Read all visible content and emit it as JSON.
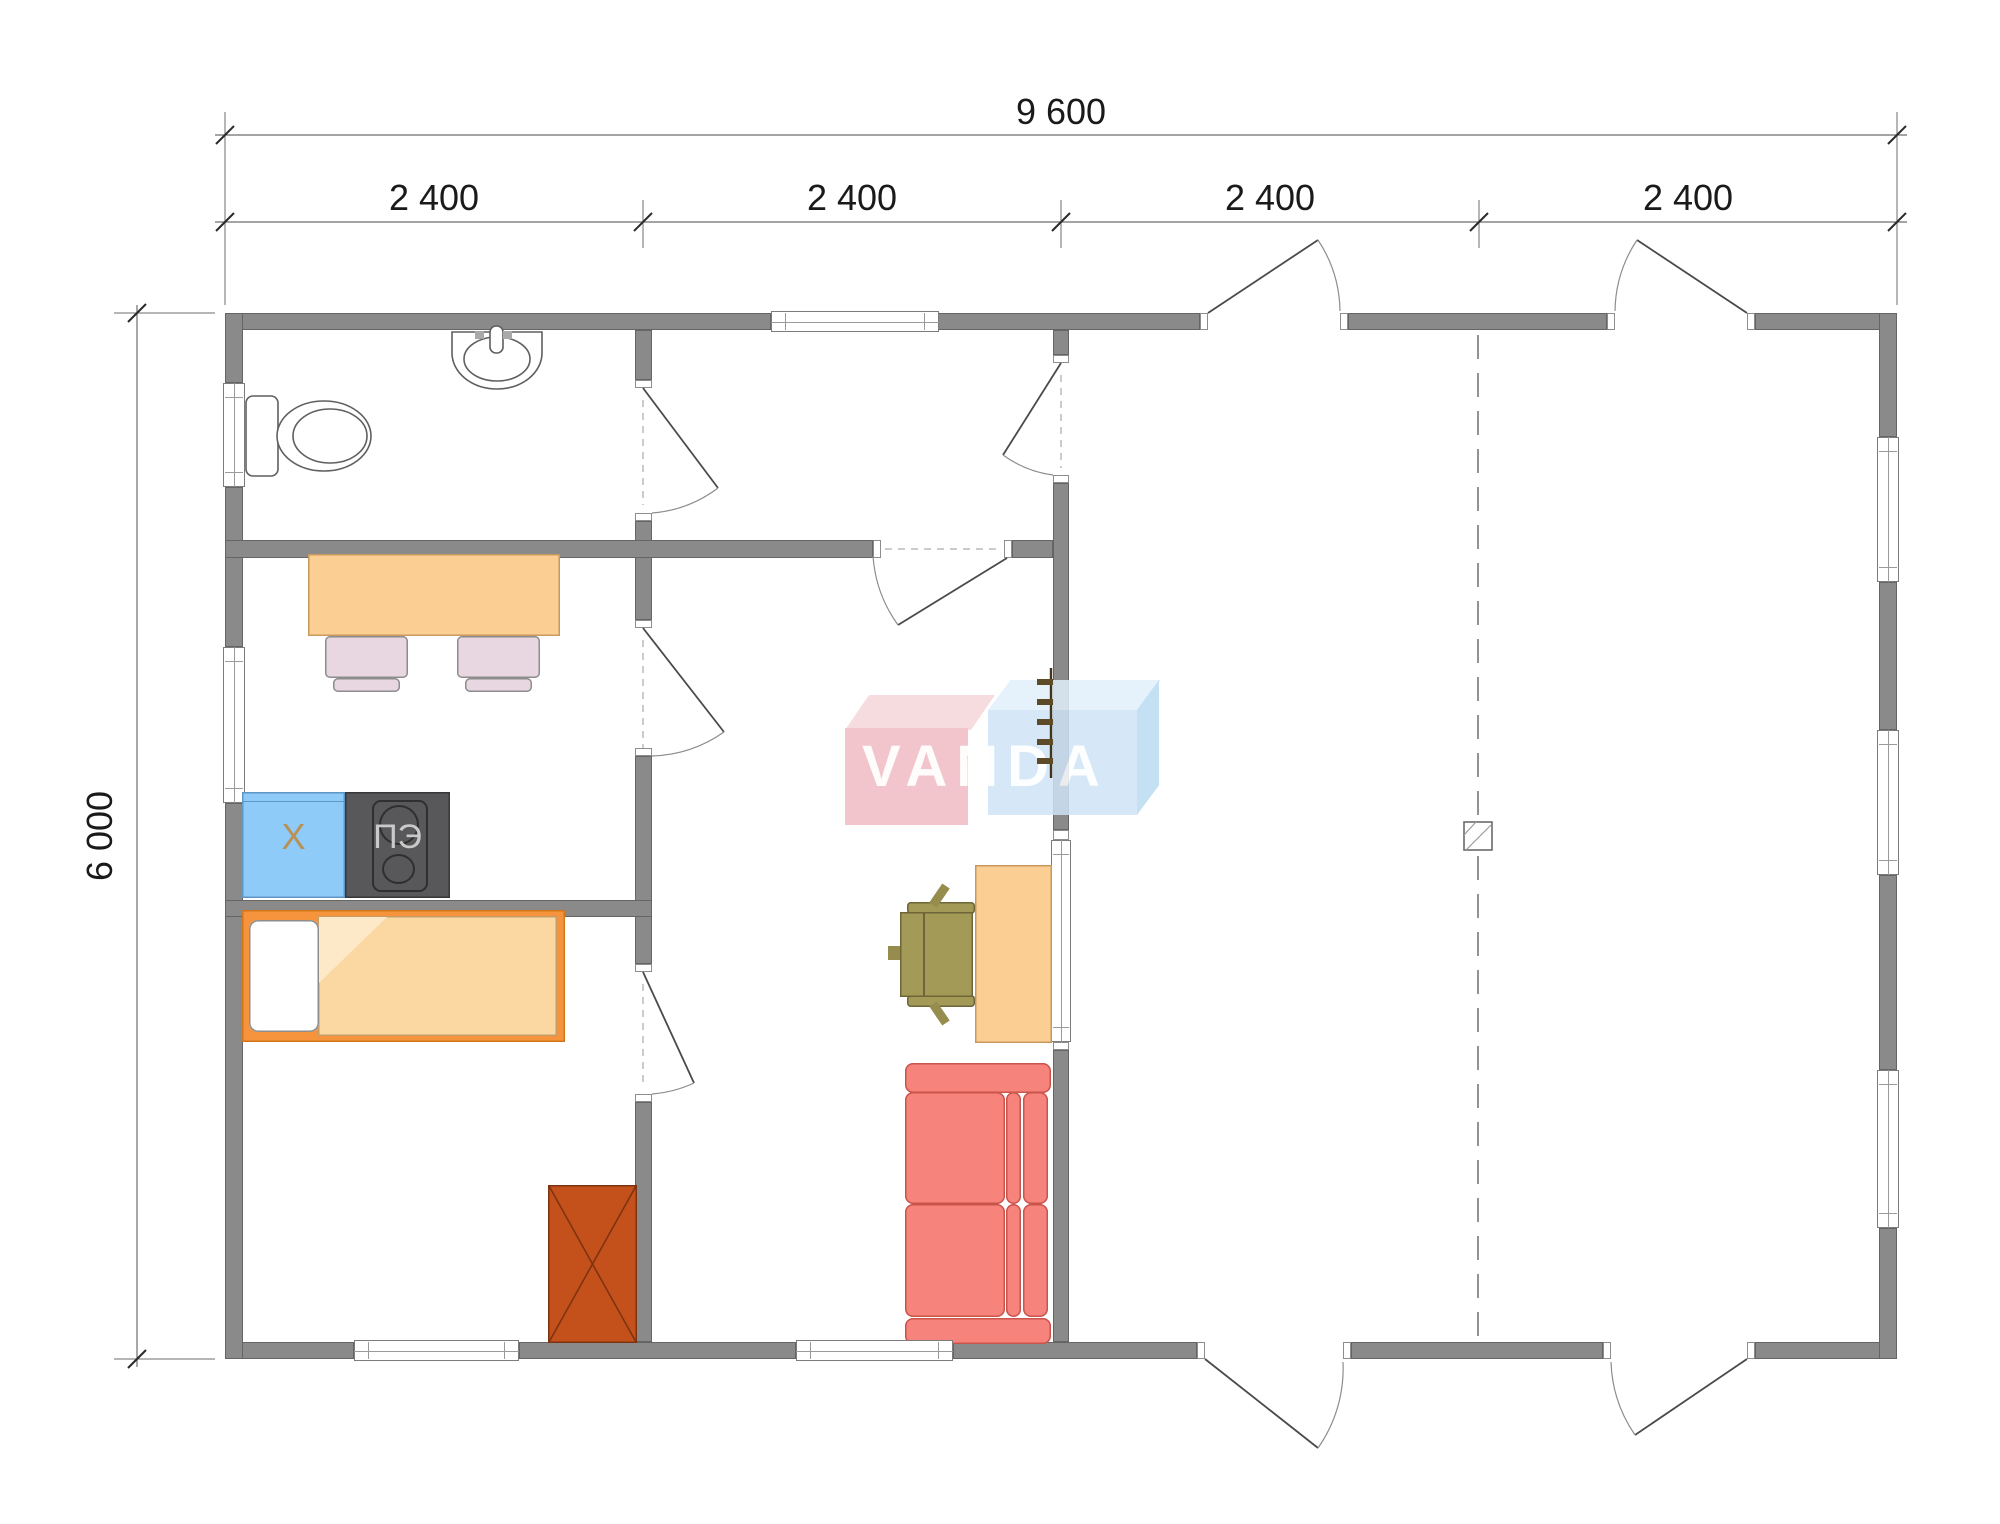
{
  "drawing": {
    "type": "floor-plan",
    "watermark": {
      "text": "VANDA",
      "red_block": "#f0bcc4",
      "blue_block": "#cfe4f6"
    },
    "dimensions": {
      "overall_width": "9 600",
      "width_segments": [
        "2 400",
        "2 400",
        "2 400",
        "2 400"
      ],
      "overall_height": "6 000"
    },
    "appliances": {
      "stove_label": "ПЭ",
      "fridge_label": "X"
    },
    "colors": {
      "wall": "#8a8a8a",
      "bed_frame": "#f5943c",
      "blanket": "#fbd7a2",
      "wardrobe": "#c4511b",
      "sofa": "#f6837c",
      "fridge": "#8ecbf9",
      "stove": "#58585a",
      "table": "#fbce93",
      "dining_chair": "#e8d6e0",
      "office_chair": "#a39a58"
    },
    "rooms": [
      "bathroom",
      "hall",
      "kitchen-dining",
      "bedroom",
      "living-room",
      "terrace"
    ]
  }
}
